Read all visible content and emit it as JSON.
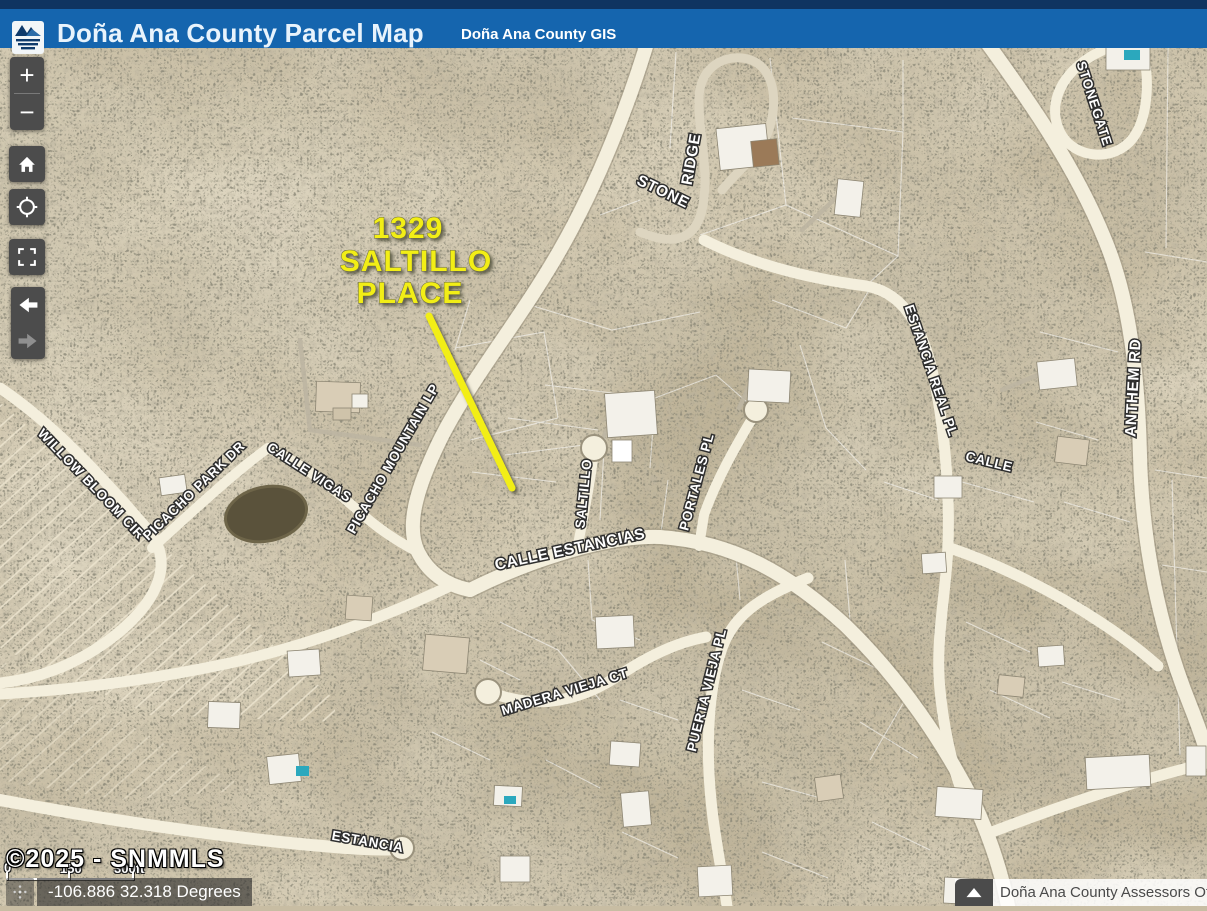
{
  "header": {
    "title": "Doña Ana County Parcel Map",
    "subtitle": "Doña Ana County GIS"
  },
  "controls": {
    "zoom_in": "+",
    "zoom_out": "−"
  },
  "map": {
    "annotation": {
      "line1": "1329",
      "line2": "SALTILLO",
      "line3": "PLACE",
      "color": "#f2ee12"
    },
    "street_labels": [
      {
        "text": "STONE"
      },
      {
        "text": "RIDGE"
      },
      {
        "text": "STONEGATE"
      },
      {
        "text": "ANTHEM RD"
      },
      {
        "text": "ESTANCIA REAL PL"
      },
      {
        "text": "CALLE"
      },
      {
        "text": "WILLOW BLOOM CIR"
      },
      {
        "text": "PICACHO PARK DR"
      },
      {
        "text": "CALLE VIGAS"
      },
      {
        "text": "PICACHO MOUNTAIN LP"
      },
      {
        "text": "SALTILLO"
      },
      {
        "text": "PORTALES PL"
      },
      {
        "text": "CALLE ESTANCIAS"
      },
      {
        "text": "MADERA VIEJA CT"
      },
      {
        "text": "PUERTA VIEJA PL"
      },
      {
        "text": "ESTANCIA"
      }
    ]
  },
  "footer": {
    "copyright": "©2025 - SNMMLS",
    "scalebar": {
      "t0": "0",
      "t1": "150",
      "t2": "300ft"
    },
    "coordinates": "-106.886 32.318 Degrees",
    "attribution": "Doña Ana County Assessors Offi"
  },
  "colors": {
    "header_blue": "#1565ae",
    "header_dark": "#0f3460",
    "road_fill": "#f4efdd",
    "annotation_yellow": "#f2ee12"
  }
}
